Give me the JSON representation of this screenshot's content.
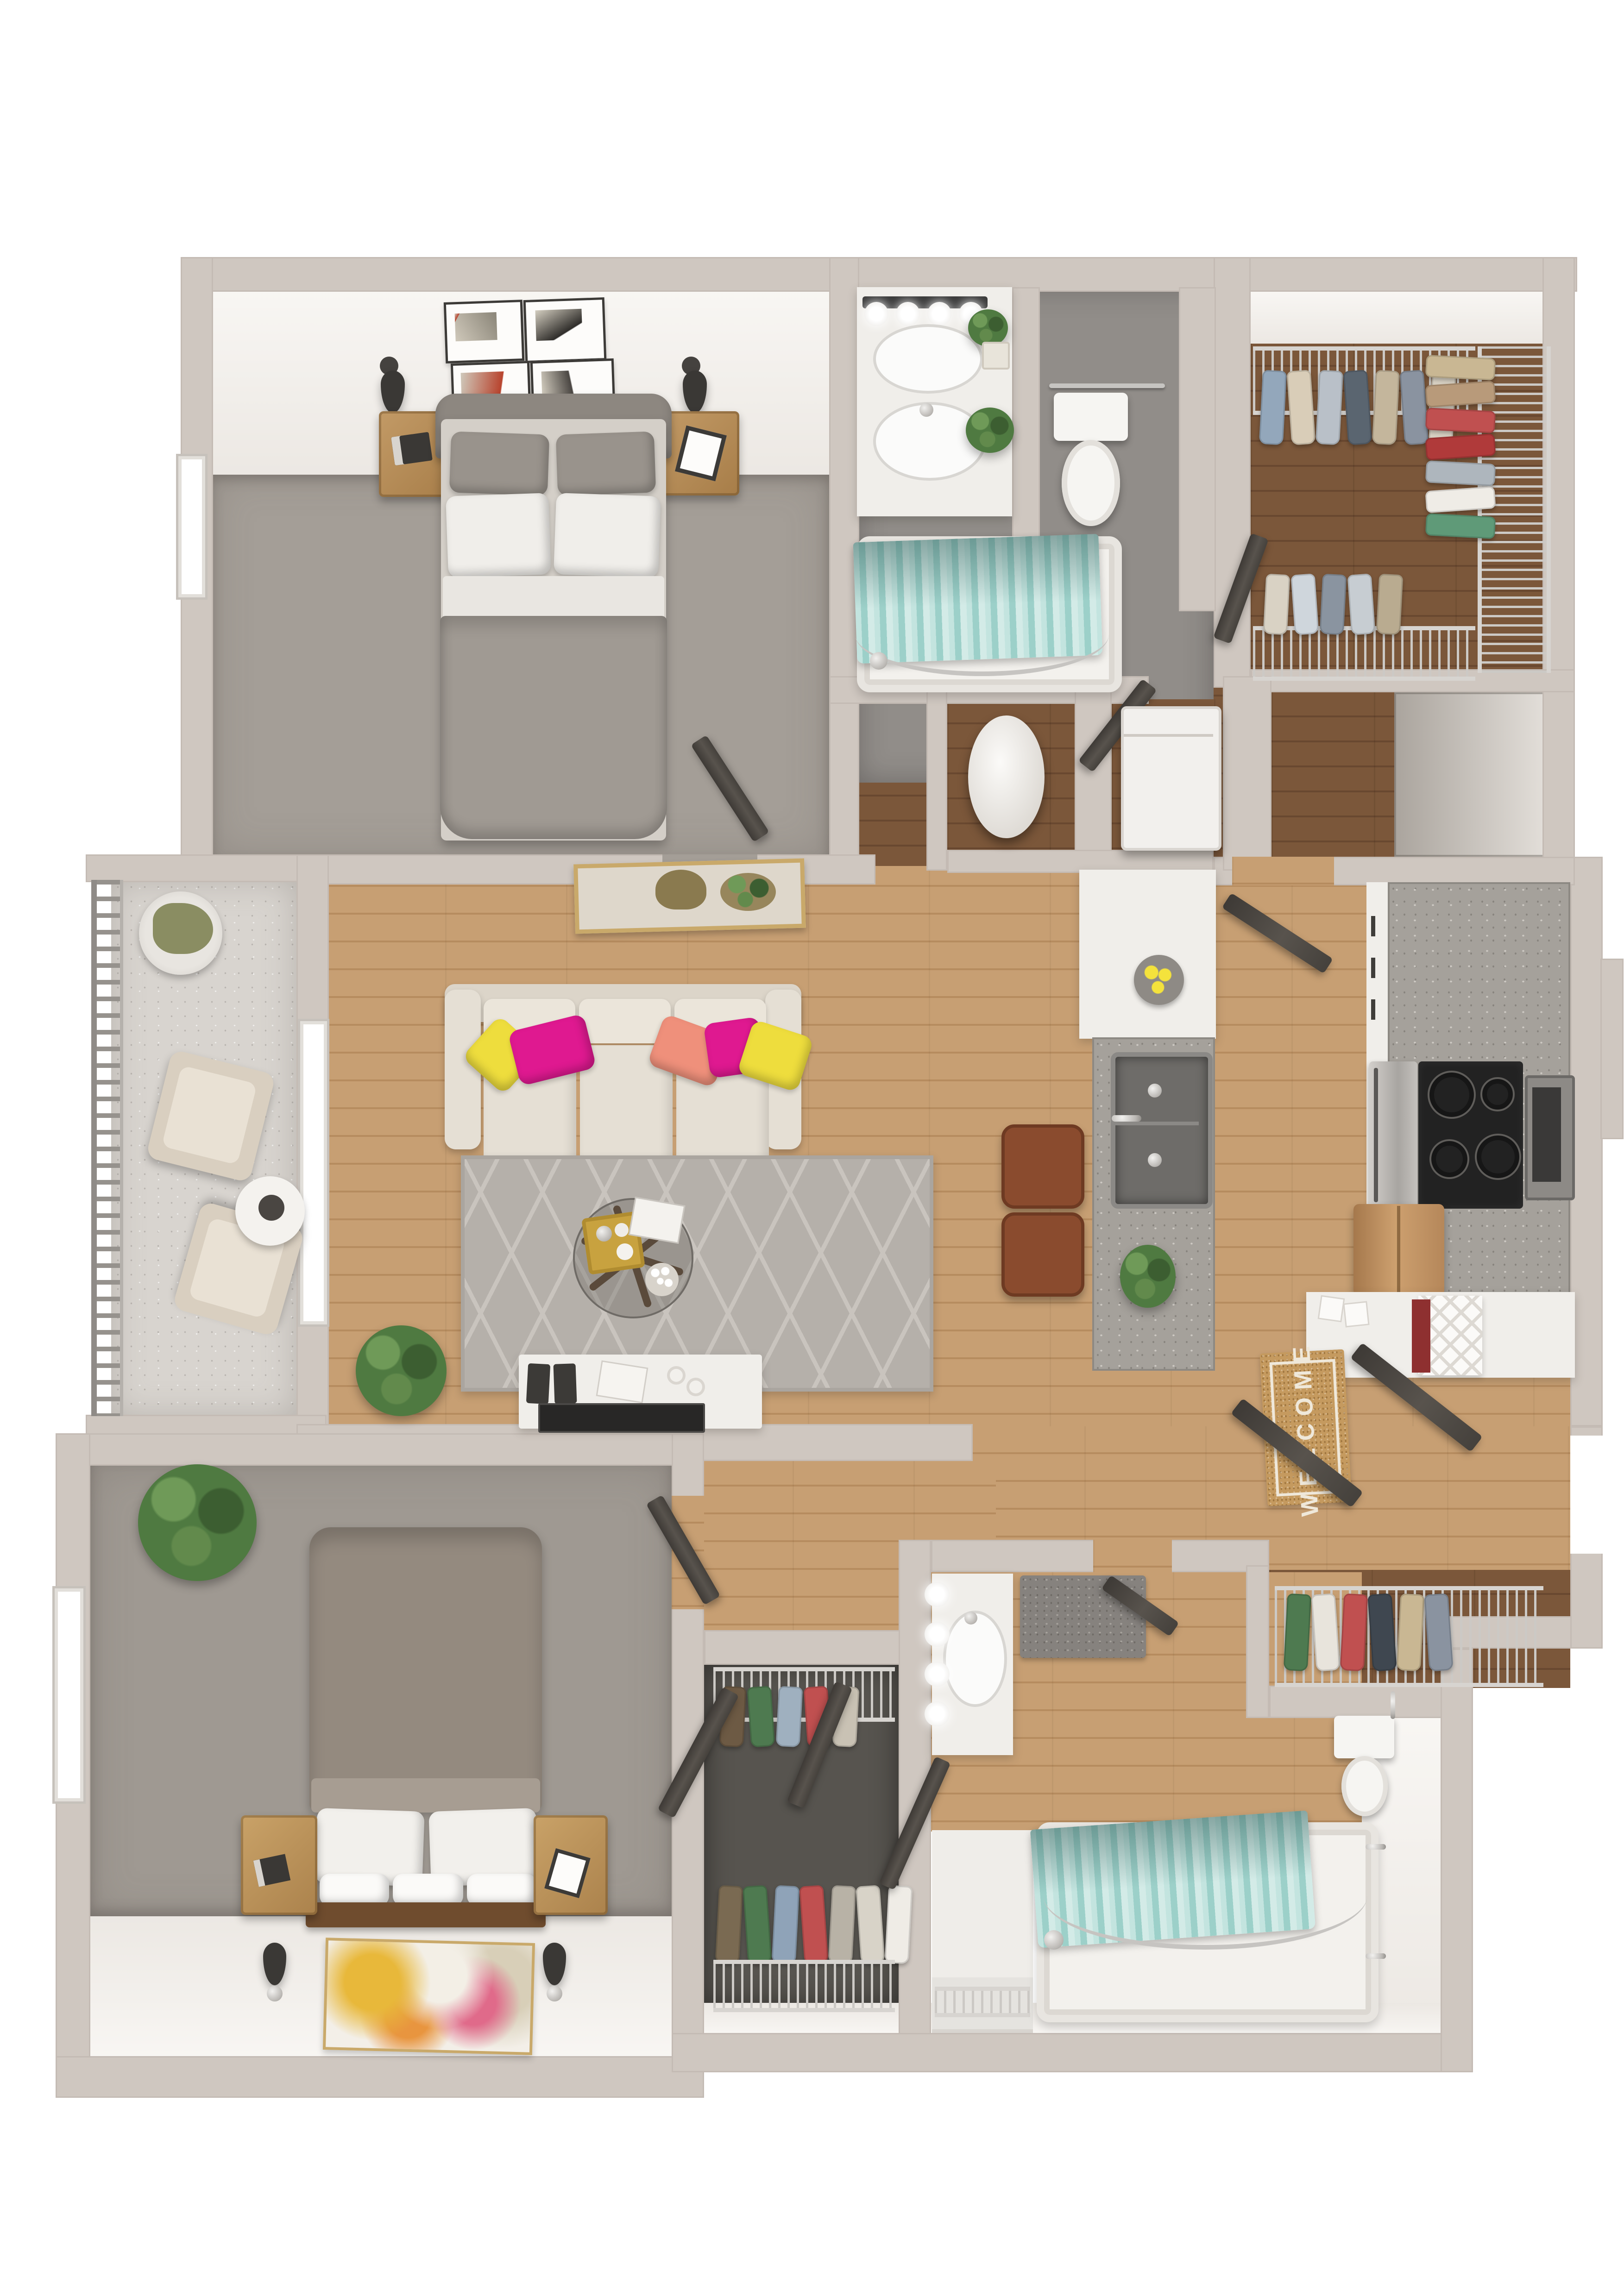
{
  "entry": {
    "welcome_mat_text": "WELCOME"
  },
  "colors": {
    "wall": "#cfc7c0",
    "face": "#f5f2ef",
    "outside": "#ffffff",
    "carpet1": "#a49e97",
    "carpet2": "#9f9992",
    "carpetdark": "#57544f",
    "wood": "#c79f73",
    "woodline": "#b68c5f",
    "wooddark": "#7b573a",
    "wooddarkline": "#694830",
    "tile": "#918d89",
    "concrete": "#d8d4cf",
    "teal": "#aedad5",
    "tealline": "#7fbcb6",
    "tealdeep": "#5d8d89",
    "sofa": "#e5dfd4",
    "cushion": "#dcd5c9",
    "pyellow": "#eedd3d",
    "pmagenta": "#df1990",
    "pcoral": "#ef907b",
    "rug": "#b5b0aa",
    "rugline": "#c9c4be",
    "tablewood": "#57422e",
    "counter": "#a5a19b",
    "cab": "#f0eeea",
    "steel": "#b5b2ae",
    "blackapp": "#222222",
    "copper": "#b5875a",
    "mat": "#c59a5f",
    "matline": "#efe8da",
    "leather": "#8a4b2e",
    "door": "#4b4742",
    "wire": "#d7d4d0",
    "plant": "#4f7a41",
    "tubfill": "#f3f1ed",
    "chrome": "#c6c4c1",
    "gold": "#c8a23f",
    "headboard": "#8d8780",
    "duvet1": "#a09a93",
    "duvet2": "#948a7f",
    "bedwood": "#6f4c2e",
    "nightstand": "#b78e5a",
    "artgold": "#c9a96a"
  },
  "closets": {
    "walkin_top": [
      "#93a7bb",
      "#d9cdb8",
      "#b9c0c8",
      "#5a6570",
      "#c4b69c",
      "#8a93a0",
      "#d9d2c4"
    ],
    "walkin_right": [
      "#c9b793",
      "#b89a7a",
      "#c05050",
      "#b03a3a",
      "#aeb6bd",
      "#efece6",
      "#5f9a78"
    ],
    "walkin_bottom": [
      "#d9d2c4",
      "#cfd6dc",
      "#8a94a0",
      "#c7cdd2",
      "#b9ab90"
    ],
    "coat_closet": [
      "#4e7a50",
      "#e8e4dc",
      "#c05050",
      "#3f4750",
      "#c9b793",
      "#8a93a0"
    ],
    "bedroom2_closet_top": [
      "#6d5a44",
      "#4e7a50",
      "#9fb0bf",
      "#c05050",
      "#c9c2b4"
    ],
    "bedroom2_closet_bottom": [
      "#7a6a52",
      "#4e7a50",
      "#8fa3b8",
      "#c05050",
      "#b8b2a6",
      "#d8d3c8",
      "#efece6"
    ]
  },
  "rooms": {
    "bedroom_1": {
      "label": "bedroom-1",
      "furniture": [
        "bed",
        "nightstand-left",
        "nightstand-right",
        "wall-art-grid",
        "sconces",
        "window"
      ]
    },
    "bathroom_1": {
      "label": "bathroom-1",
      "furniture": [
        "vanity-sink",
        "vanity-lights",
        "toilet",
        "bathtub",
        "shower-curtain"
      ]
    },
    "walkin_closet": {
      "label": "walk-in-closet",
      "furniture": [
        "wire-shelving",
        "hanging-clothes"
      ]
    },
    "living_room": {
      "label": "living-room",
      "furniture": [
        "sofa",
        "throw-pillows",
        "area-rug",
        "coffee-table",
        "tv-console",
        "plant",
        "palm-painting",
        "window"
      ]
    },
    "kitchen": {
      "label": "kitchen",
      "furniture": [
        "peninsula-bar",
        "double-sink",
        "bar-stools",
        "range-cooktop",
        "oven",
        "microwave",
        "refrigerator",
        "wine-rack",
        "lemon-bowl"
      ]
    },
    "balcony": {
      "label": "balcony",
      "furniture": [
        "railing",
        "lounge-chairs",
        "side-table",
        "cactus-planter"
      ]
    },
    "entry": {
      "label": "entry-hall",
      "furniture": [
        "welcome-mat",
        "entry-doors",
        "coat-closet"
      ]
    },
    "utility": {
      "label": "utility-closets",
      "furniture": [
        "water-heater",
        "washer-dryer",
        "stairs"
      ]
    },
    "bedroom_2": {
      "label": "bedroom-2",
      "furniture": [
        "bed",
        "nightstand-left",
        "nightstand-right",
        "abstract-painting",
        "sconces",
        "plant",
        "window"
      ]
    },
    "closet_2": {
      "label": "bedroom-2-closet",
      "furniture": [
        "wire-shelving",
        "hanging-clothes",
        "closet-doors"
      ]
    },
    "bathroom_2": {
      "label": "bathroom-2",
      "furniture": [
        "vanity-sink",
        "vanity-lights",
        "toilet",
        "bathtub",
        "shower-curtain",
        "linen-shelves",
        "bath-rug"
      ]
    }
  }
}
